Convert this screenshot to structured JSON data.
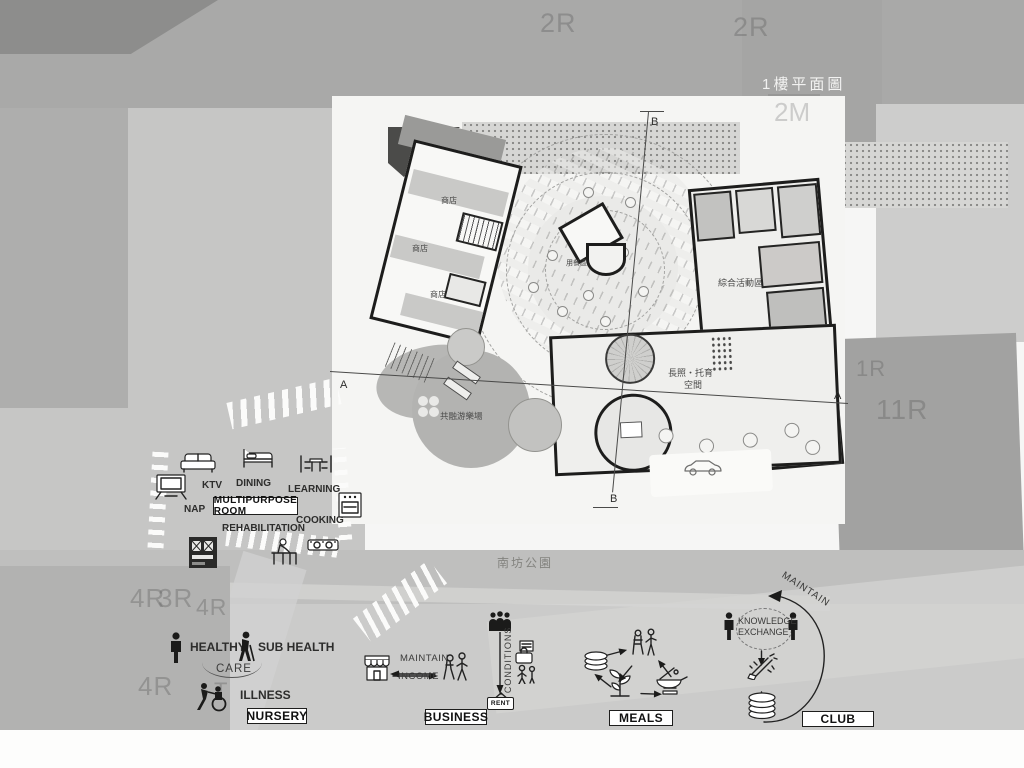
{
  "header": {
    "title": "1樓平面圖"
  },
  "site": {
    "label_2r_a": "2R",
    "label_2r_b": "2R",
    "label_2m": "2M",
    "label_1r": "1R",
    "label_11r": "11R",
    "label_4r_a": "4R",
    "label_3r": "3R",
    "label_4r_b": "4R",
    "label_4r_c": "4R",
    "label_t": "T",
    "park": "南坊公園"
  },
  "plan": {
    "shop_1": "商店",
    "shop_2": "商店",
    "shop_3": "商店",
    "dining": "用餐區",
    "activity": "綜合活動區",
    "care_1": "長照・托育",
    "care_2": "空間",
    "playground": "共融游樂場",
    "section_a_left": "A",
    "section_a_right": "A",
    "section_b_top": "B",
    "section_b_bottom": "B"
  },
  "multipurpose": {
    "box": "MULTIPURPOSE ROOM",
    "nap": "NAP",
    "ktv": "KTV",
    "dining": "DINING",
    "learning": "LEARNING",
    "rehabilitation": "REHABILITATION",
    "cooking": "COOKING"
  },
  "nursery": {
    "healthy": "HEALTHY",
    "sub_health": "SUB HEALTH",
    "care": "CARE",
    "illness": "ILLNESS",
    "box": "NURSERY"
  },
  "business": {
    "maintain": "MAINTAIN",
    "income": "INCOME",
    "conditions": "CONDITIONS",
    "rent": "RENT",
    "box": "BUSINESS"
  },
  "meals": {
    "box": "MEALS"
  },
  "club": {
    "maintain": "MAINTAIN",
    "knowledge_1": "KNOWLEDGE",
    "knowledge_2": "EXCHANGE",
    "box": "CLUB"
  },
  "colors": {
    "wall": "#1d1d1c",
    "paper": "#f5f5f3",
    "road": "#c6c6c5",
    "top_band": "#a9a9a8",
    "park_band": "#bfbfbe",
    "bottom_band": "#cbcbca",
    "ink": "#2d2d2c"
  }
}
